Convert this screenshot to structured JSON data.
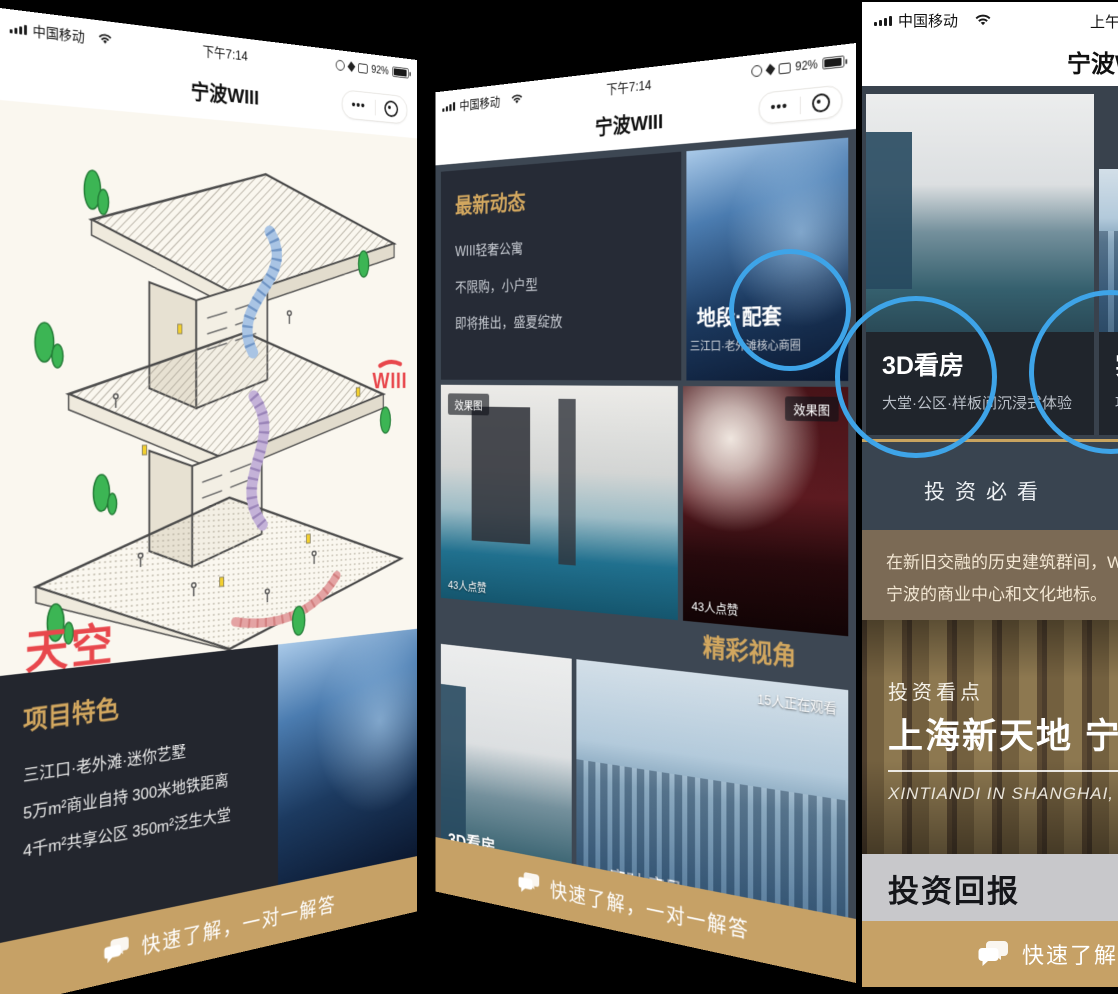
{
  "app_title": "宁波WIII",
  "colors": {
    "gold_bar": "#c6a166",
    "gold_text": "#d2a75f",
    "accent_red": "#e8474c",
    "ring_blue": "#3ea4e8",
    "panel_dark": "#23262e"
  },
  "status": {
    "carrier": "中国移动",
    "time_pm": "下午7:14",
    "time_am": "上午",
    "battery": "92%",
    "more": "•••"
  },
  "cta_label": "快速了解，一对一解答",
  "badge_render": "效果图",
  "phone_left": {
    "slogan_line1": "天空",
    "slogan_line2": "跑道。",
    "logo": "WIII",
    "panel_title": "项目特色",
    "panel_lines": [
      "三江口·老外滩·迷你艺墅",
      "5万m²商业自持 300米地铁距离",
      "4千m²共享公区 350m²泛生大堂"
    ]
  },
  "phone_mid": {
    "news_title": "最新动态",
    "news_lines": [
      "WIII轻奢公寓",
      "不限购，小户型",
      "即将推出，盛夏绽放"
    ],
    "loc_title": "地段·配套",
    "loc_sub": "三江口·老外滩核心商圈",
    "likes": "43人点赞",
    "section_title": "精彩视角",
    "viewers": "15人正在观看",
    "cap_3d": "3D看房",
    "cap_live": "实时·实景"
  },
  "phone_right": {
    "card3d_title": "3D看房",
    "card3d_sub": "大堂·公区·样板间沉浸式体验",
    "cardlive_title": "实时·实景",
    "cardlive_sub": "项目",
    "section_invest": "投资必看",
    "brown_lines": [
      "在新旧交融的历史建筑群间，WIII",
      "宁波的商业中心和文化地标。"
    ],
    "spot_label": "投资看点",
    "spot_title": "上海新天地 宁波",
    "spot_en": "XINTIANDI IN SHANGHAI, SHIK",
    "roi_title": "投资回报"
  }
}
